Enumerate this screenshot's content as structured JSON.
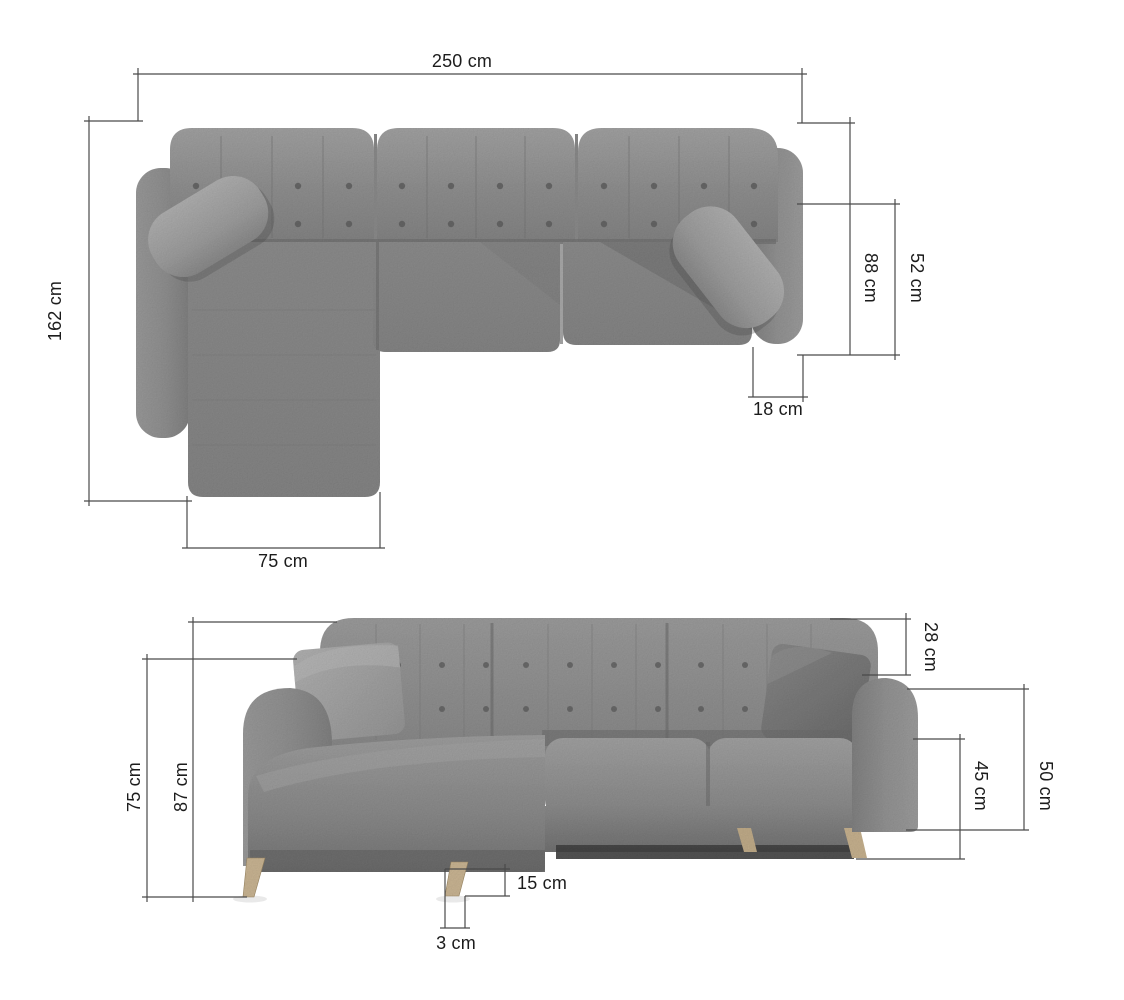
{
  "dimensions": {
    "top_view": {
      "total_width": "250 cm",
      "total_depth": "162 cm",
      "chaise_width": "75 cm",
      "inner_depth": "88 cm",
      "seat_depth": "52 cm",
      "armrest_width": "18 cm"
    },
    "front_view": {
      "total_height": "87 cm",
      "armrest_floor_height": "75 cm",
      "backrest_above_armrest": "28 cm",
      "armrest_height": "50 cm",
      "seat_height": "45 cm",
      "leg_height": "15 cm",
      "leg_offset": "3 cm"
    }
  },
  "colors": {
    "sofa_fabric": "#8f8f8f",
    "pillow_light": "#aaaaaa",
    "pillow_dark": "#7b7b7b",
    "leg_wood": "#ccb795",
    "dimension_line": "#4a4a4a",
    "label_text": "#1c1c1c",
    "background": "#ffffff"
  }
}
